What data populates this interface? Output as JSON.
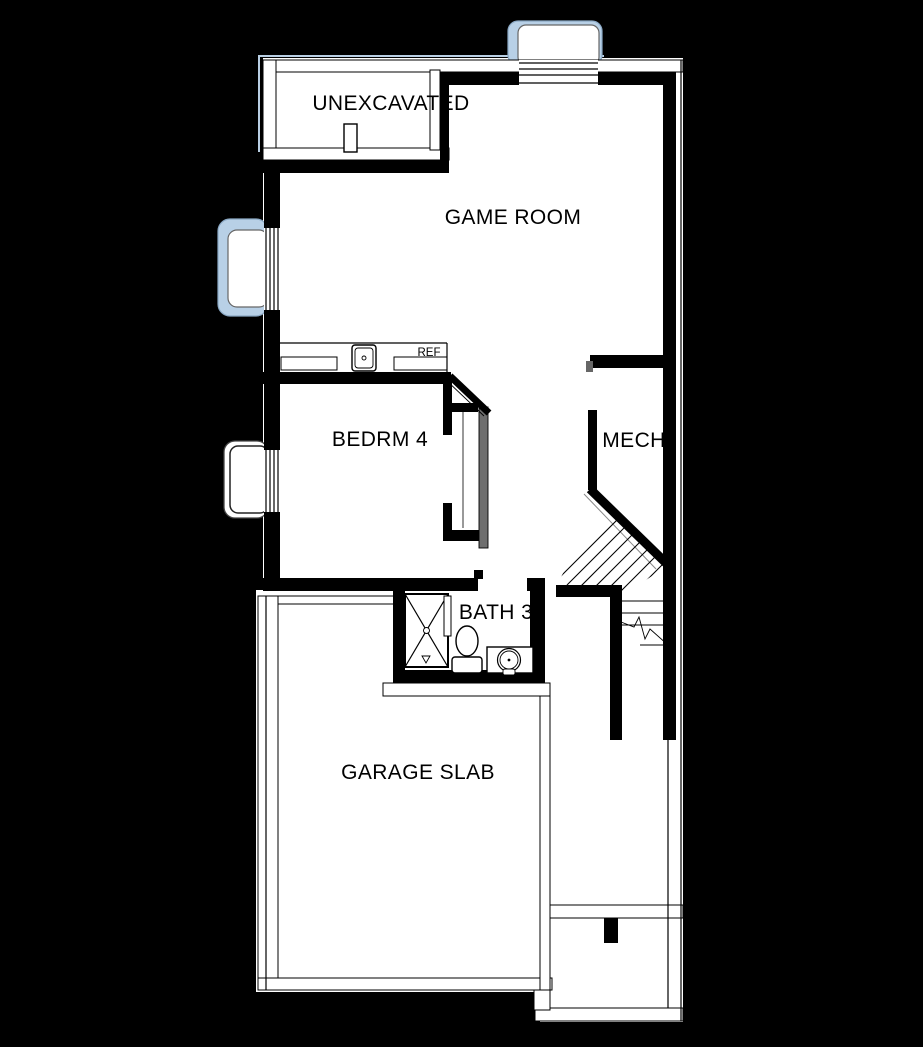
{
  "plan": {
    "rooms": [
      {
        "name": "unexcavated",
        "label": "UNEXCAVATED"
      },
      {
        "name": "game-room",
        "label": "GAME ROOM"
      },
      {
        "name": "bedroom-4",
        "label": "BEDRM 4"
      },
      {
        "name": "mechanical",
        "label": "MECH"
      },
      {
        "name": "bath-3",
        "label": "BATH 3"
      },
      {
        "name": "garage",
        "label": "GARAGE SLAB"
      }
    ],
    "fixture_labels": {
      "refrigerator": "REF"
    },
    "colors": {
      "background": "#000000",
      "paper": "#ffffff",
      "wall": "#000000",
      "window_well": "#b8d0e6",
      "well_outline": "#8aa8c4",
      "foundation_hint": "#b9cfe4"
    }
  }
}
